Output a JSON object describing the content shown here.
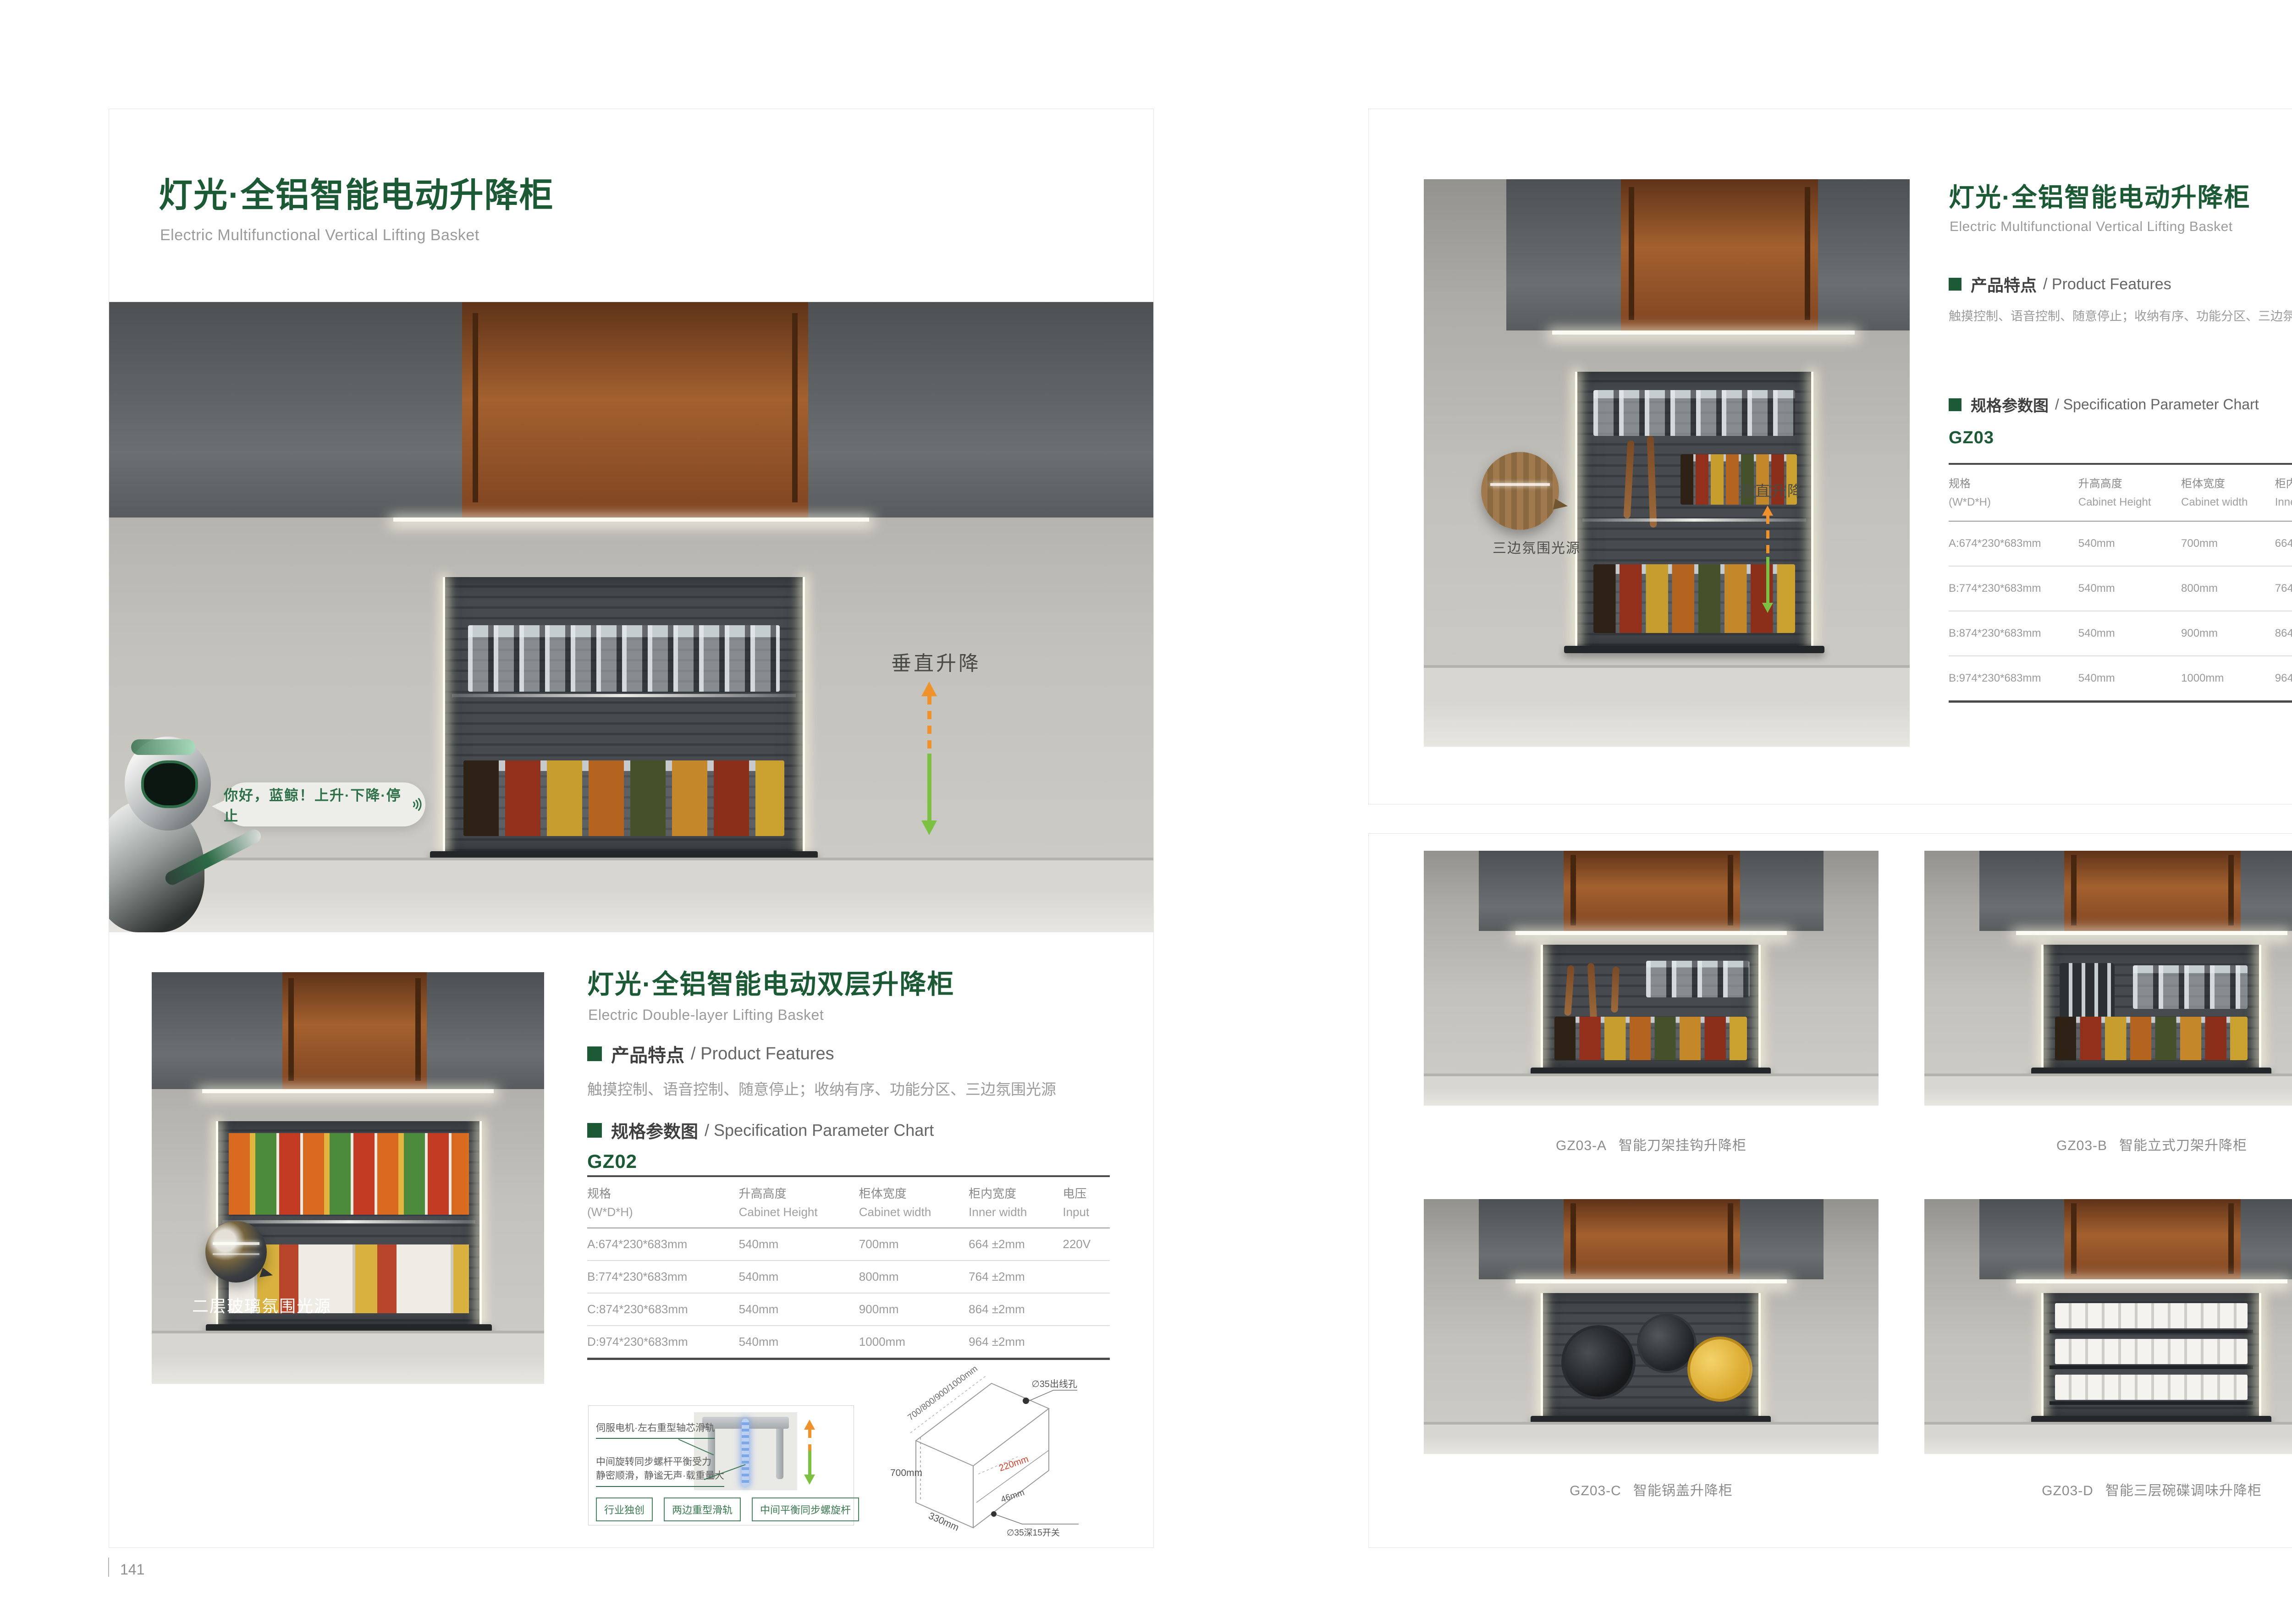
{
  "left": {
    "page_number": "141",
    "title": "灯光·全铝智能电动升降柜",
    "subtitle": "Electric Multifunctional Vertical Lifting Basket",
    "hero": {
      "bubble_text": "你好，蓝鲸！上升·下降·停止",
      "lift_label": "垂直升降"
    },
    "second": {
      "title": "灯光·全铝智能电动双层升降柜",
      "subtitle": "Electric Double-layer Lifting Basket",
      "features_zh": "产品特点",
      "features_en": "/ Product Features",
      "features_text": "触摸控制、语音控制、随意停止；收纳有序、功能分区、三边氛围光源",
      "spec_zh": "规格参数图",
      "spec_en": "/ Specification Parameter Chart",
      "model": "GZ02",
      "photo_caption": "二层玻璃氛围光源"
    },
    "table": {
      "headers_zh": [
        "规格",
        "升高高度",
        "柜体宽度",
        "柜内宽度",
        "电压"
      ],
      "headers_en": [
        "(W*D*H)",
        "Cabinet Height",
        "Cabinet width",
        "Inner width",
        "Input"
      ],
      "rows": [
        [
          "A:674*230*683mm",
          "540mm",
          "700mm",
          "664 ±2mm",
          "220V"
        ],
        [
          "B:774*230*683mm",
          "540mm",
          "800mm",
          "764 ±2mm",
          ""
        ],
        [
          "C:874*230*683mm",
          "540mm",
          "900mm",
          "864 ±2mm",
          ""
        ],
        [
          "D:974*230*683mm",
          "540mm",
          "1000mm",
          "964 ±2mm",
          ""
        ]
      ]
    },
    "diagram": {
      "label_top": "伺服电机·左右重型轴芯滑轨",
      "label_bottom_1": "中间旋转同步螺杆平衡受力",
      "label_bottom_2": "静密顺滑，静谧无声·载重量大",
      "tags": [
        "行业独创",
        "两边重型滑轨",
        "中间平衡同步螺旋杆"
      ]
    },
    "iso": {
      "dim_width": "700/800/900/1000mm",
      "hole": "∅35出线孔",
      "dim_height": "700mm",
      "dim_inner": "220mm",
      "dim_small": "46mm",
      "switch": "∅35深15开关",
      "dim_depth": "330mm"
    }
  },
  "right": {
    "page_number": "142",
    "title": "灯光·全铝智能电动升降柜",
    "subtitle": "Electric Multifunctional Vertical Lifting Basket",
    "features_zh": "产品特点",
    "features_en": "/ Product Features",
    "features_text": "触摸控制、语音控制、随意停止；收纳有序、功能分区、三边氛围光源",
    "spec_zh": "规格参数图",
    "spec_en": "/ Specification Parameter Chart",
    "model": "GZ03",
    "photo_callout": "三边氛围光源",
    "lift_label": "垂直升降",
    "table": {
      "headers_zh": [
        "规格",
        "升高高度",
        "柜体宽度",
        "柜内宽度",
        "电压"
      ],
      "headers_en": [
        "(W*D*H)",
        "Cabinet Height",
        "Cabinet width",
        "Inner width",
        "Input"
      ],
      "rows": [
        [
          "A:674*230*683mm",
          "540mm",
          "700mm",
          "664 ±2mm",
          "220V"
        ],
        [
          "B:774*230*683mm",
          "540mm",
          "800mm",
          "764 ±2mm",
          ""
        ],
        [
          "B:874*230*683mm",
          "540mm",
          "900mm",
          "864 ±2mm",
          ""
        ],
        [
          "B:974*230*683mm",
          "540mm",
          "1000mm",
          "964 ±2mm",
          ""
        ]
      ]
    },
    "products": [
      {
        "code": "GZ03-A",
        "name": "智能刀架挂钩升降柜"
      },
      {
        "code": "GZ03-B",
        "name": "智能立式刀架升降柜"
      },
      {
        "code": "GZ03-C",
        "name": "智能锅盖升降柜"
      },
      {
        "code": "GZ03-D",
        "name": "智能三层碗碟调味升降柜"
      }
    ]
  }
}
